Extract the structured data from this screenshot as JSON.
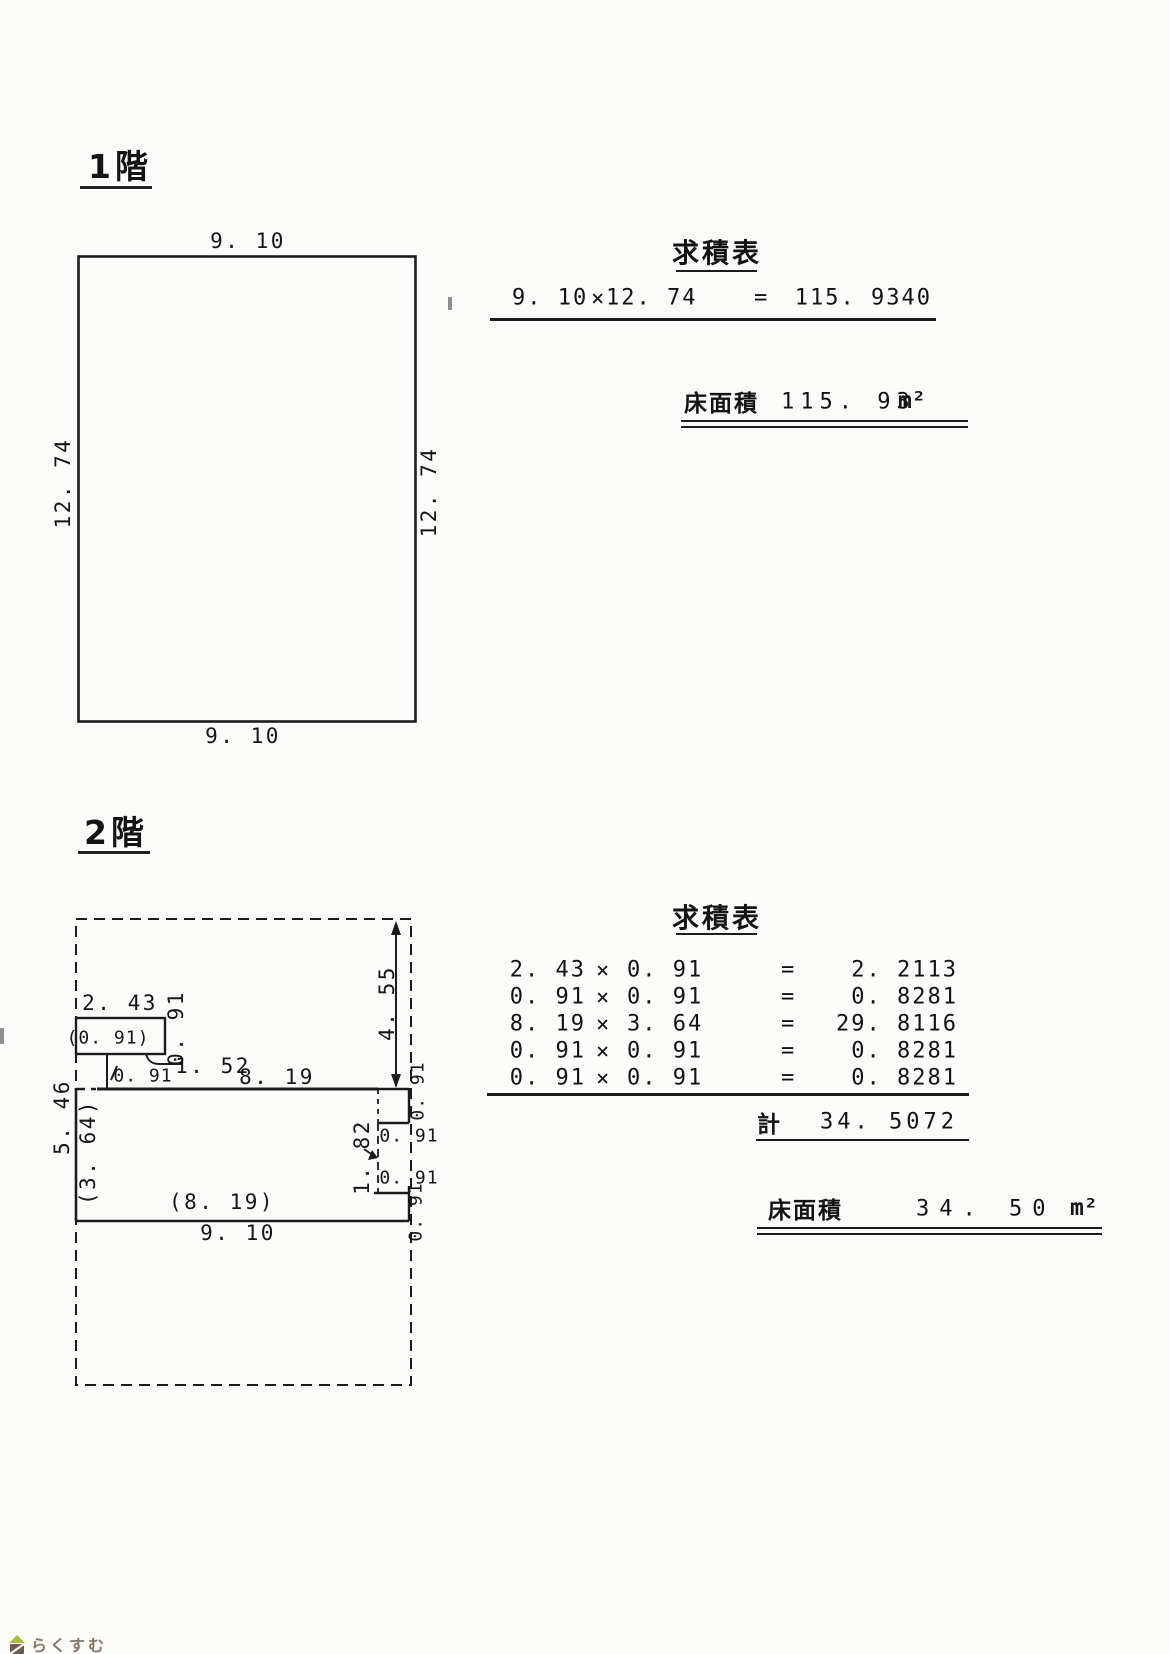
{
  "document": {
    "bg": "#fbfbf9",
    "ink": "#1c1c1c"
  },
  "floor1": {
    "heading": "1階",
    "plan": {
      "dim_top": "9. 10",
      "dim_left": "12. 74",
      "dim_right": "12. 74",
      "dim_bottom": "9. 10"
    },
    "table": {
      "title": "求積表",
      "op": "×",
      "eq": "=",
      "rows": [
        {
          "a": "9. 10",
          "b": "12. 74",
          "result": "115. 9340"
        }
      ],
      "floor_area_label": "床面積",
      "floor_area_value": "115. 93",
      "floor_area_unit": "m²"
    }
  },
  "floor2": {
    "heading": "2階",
    "plan": {
      "labels": [
        "2. 43",
        "0. 91",
        "(0. 91)",
        "1. 52",
        "0. 91",
        "8. 19",
        "4. 55",
        "0. 91",
        "5. 46",
        "(3. 64)",
        "1. 82",
        "0. 91",
        "0. 91",
        "(8. 19)",
        "9. 10",
        "0. 91"
      ]
    },
    "table": {
      "title": "求積表",
      "op": "×",
      "eq": "=",
      "rows": [
        {
          "a": "2. 43",
          "b": "0. 91",
          "result": "2. 2113"
        },
        {
          "a": "0. 91",
          "b": "0. 91",
          "result": "0. 8281"
        },
        {
          "a": "8. 19",
          "b": "3. 64",
          "result": "29. 8116"
        },
        {
          "a": "0. 91",
          "b": "0. 91",
          "result": "0. 8281"
        },
        {
          "a": "0. 91",
          "b": "0. 91",
          "result": "0. 8281"
        }
      ],
      "total_label": "計",
      "total_value": "34. 5072",
      "floor_area_label": "床面積",
      "floor_area_value": "34. 50",
      "floor_area_unit": "m²"
    }
  },
  "footer": {
    "logo_text": "らくすむ"
  }
}
